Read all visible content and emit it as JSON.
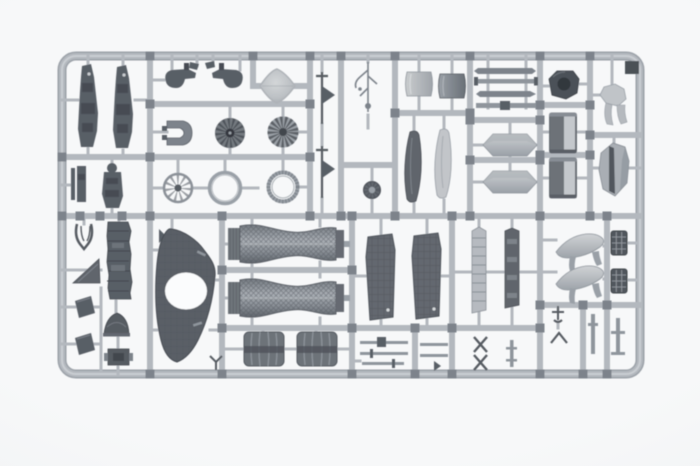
{
  "scene": {
    "description": "Photograph of a gray injection-molded plastic model kit sprue (parts tree) laid on a plain white background; no text is visible",
    "subject": "Scale model kit sprue holding aircraft engine, fuselage, intake and small detail parts",
    "material": "gray polystyrene plastic",
    "text_visible": "none"
  },
  "colors": {
    "background": "#f7f8f9",
    "backgroundEdge": "#edeff1",
    "runner": "#b3b8be",
    "runnerEdge": "#9ba1a8",
    "runnerHi": "#c9cdd2",
    "pad": "#7d838b",
    "partDark": "#595e66",
    "partDarker": "#464b52",
    "partMid": "#7d838b",
    "partGray": "#8f959c",
    "partLight": "#c3c7cb",
    "white": "#fbfcfd"
  },
  "parts_inventory": [
    {
      "name": "ejection seats",
      "count": 2
    },
    {
      "name": "hook brackets",
      "count": 2
    },
    {
      "name": "nose cone spinner",
      "count": 1
    },
    {
      "name": "turbine fan discs",
      "count": 2
    },
    {
      "name": "spoked wheel ring",
      "count": 1
    },
    {
      "name": "plain ring",
      "count": 1
    },
    {
      "name": "ribbed ring",
      "count": 1
    },
    {
      "name": "blade antennas",
      "count": 2
    },
    {
      "name": "pitot branch",
      "count": 1
    },
    {
      "name": "small wheel",
      "count": 1
    },
    {
      "name": "intake lip shells",
      "count": 2
    },
    {
      "name": "long blades",
      "count": 2
    },
    {
      "name": "thin spars",
      "count": 4
    },
    {
      "name": "drop tank halves",
      "count": 2
    },
    {
      "name": "exhaust collar",
      "count": 1
    },
    {
      "name": "gear leg fairing",
      "count": 1
    },
    {
      "name": "cylinder halves",
      "count": 2
    },
    {
      "name": "hexagonal panel",
      "count": 1
    },
    {
      "name": "wishbone fork",
      "count": 1
    },
    {
      "name": "wedge",
      "count": 1
    },
    {
      "name": "pad plates",
      "count": 2
    },
    {
      "name": "cockpit tub",
      "count": 1
    },
    {
      "name": "dome fairing",
      "count": 1
    },
    {
      "name": "equipment box",
      "count": 1
    },
    {
      "name": "curved duct panel with round opening",
      "count": 1
    },
    {
      "name": "afterburner engine pipes",
      "count": 2
    },
    {
      "name": "ribbed cylinder halves",
      "count": 2
    },
    {
      "name": "intake ramp panels",
      "count": 2
    },
    {
      "name": "narrow strips",
      "count": 2
    },
    {
      "name": "canopy fairing shells",
      "count": 2
    },
    {
      "name": "grille plates",
      "count": 2
    },
    {
      "name": "small rods and fittings",
      "count": 12
    }
  ]
}
